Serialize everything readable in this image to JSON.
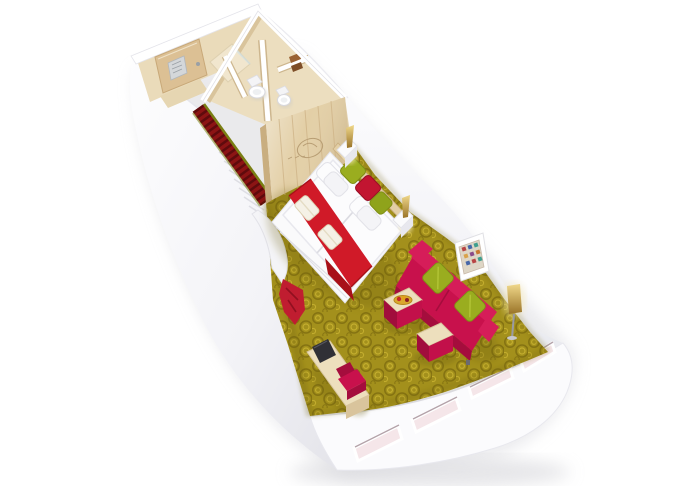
{
  "scene": {
    "subject": "3D isometric cutaway floor-plan rendering of a ship cabin suite",
    "background": "#ffffff"
  },
  "rooms": [
    "entrance-hallway",
    "bathroom",
    "wc",
    "wardrobe",
    "bedroom",
    "living-area",
    "panorama-window-front"
  ],
  "furniture": [
    "entrance-door",
    "hallway-runner-carpet",
    "shower",
    "toilet",
    "wc-toilet",
    "towel-shelf",
    "wardrobe-cabinet",
    "double-bed",
    "bed-runner",
    "folded-towels",
    "white-pillows",
    "accent-pillows",
    "headboard-shelf",
    "nightstand",
    "wall-sconce-lamp",
    "rosette-carpet",
    "curved-partition",
    "red-floor-throw",
    "vanity-desk",
    "tv",
    "desk-chair",
    "sofa",
    "sofa-cushions",
    "coffee-table-cube",
    "fruit-tray",
    "side-stool-cube",
    "floor-lamp",
    "framed-artwork",
    "panorama-window"
  ],
  "counts": {
    "windows": 4,
    "toilets": 2,
    "wall_lamps": 2,
    "sofa_cushions": 2,
    "bed_towels": 2
  },
  "palette": {
    "background": "#ffffff",
    "hull_white": "#fbfbfd",
    "hull_shade": "#e8e8ee",
    "beige_wall": "#eadbba",
    "beige_shadow": "#d9c49c",
    "tile_floor": "#ecdebf",
    "wood": "#e3cfa6",
    "wood_dark": "#c9ae80",
    "door_wood": "#dcc094",
    "hall_carpet": "#8c1414",
    "hall_carpet_dark": "#5f0b0d",
    "fringe_olive": "#7a7f14",
    "carpet_base": "#a3901c",
    "carpet_dark": "#857312",
    "carpet_light": "#c4ae2e",
    "bed_white": "#fafafb",
    "bed_shadow": "#e2e2e8",
    "runner_red": "#d01a28",
    "runner_dark": "#a81018",
    "towel": "#f5f1e6",
    "pillow_green": "#9aad1f",
    "pillow_green_dark": "#7e8f15",
    "pillow_red": "#c21531",
    "sofa": "#c8114c",
    "sofa_dark": "#a50d3d",
    "sofa_light": "#d61d59",
    "table_top": "#eddfbd",
    "table_side": "#c2104a",
    "tray_gold": "#d9a92e",
    "lamp_gold": "#d9b152",
    "lamp_glow": "#f7e9b4",
    "glass_pink": "#f5e6e9",
    "tv_dark": "#303036",
    "plaque_silver": "#d4d7da"
  }
}
